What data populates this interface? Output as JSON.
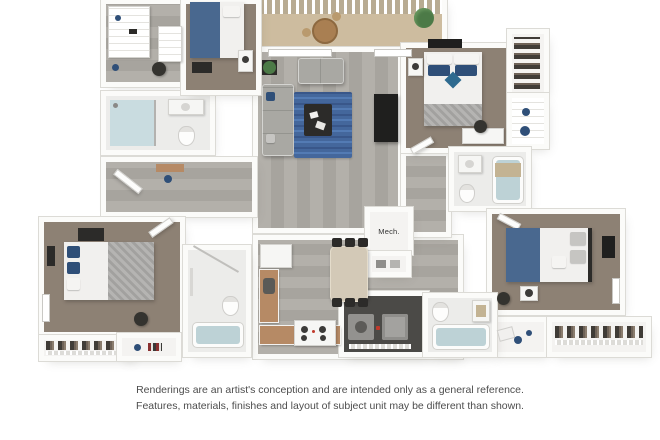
{
  "scene": {
    "type": "3d-floorplan-rendering"
  },
  "labels": {
    "mech_closet": "Mech."
  },
  "disclaimer": {
    "line1": "Renderings are an artist's conception and are intended only as a general reference.",
    "line2": "Features, materials, finishes and layout of subject unit may be different than shown."
  },
  "palette": {
    "wall": "#fbfbf9",
    "wall_edge": "#dcdbd6",
    "wood_a": "#b3b0aa",
    "wood_b": "#a7a49e",
    "carpet": "#8d8174",
    "bed_blue": "#49688f",
    "pillow_blue": "#2f4f78",
    "blanket_a": "#b5b4b2",
    "blanket_b": "#a2a19f",
    "sofa": "#a9a8a3",
    "rug": "#44679c",
    "counter": "#b68a65",
    "table_tan": "#d3c9b7",
    "dark": "#2c2b29",
    "water": "#bdd2d6",
    "shower_tile": "#c9dce0",
    "plant": "#4c7a47",
    "balcony": "#cdbc9f",
    "clothes_a": "#403c37",
    "clothes_b": "#6e6257",
    "accent_red": "#c0392b",
    "text": "#4d4d4d"
  }
}
